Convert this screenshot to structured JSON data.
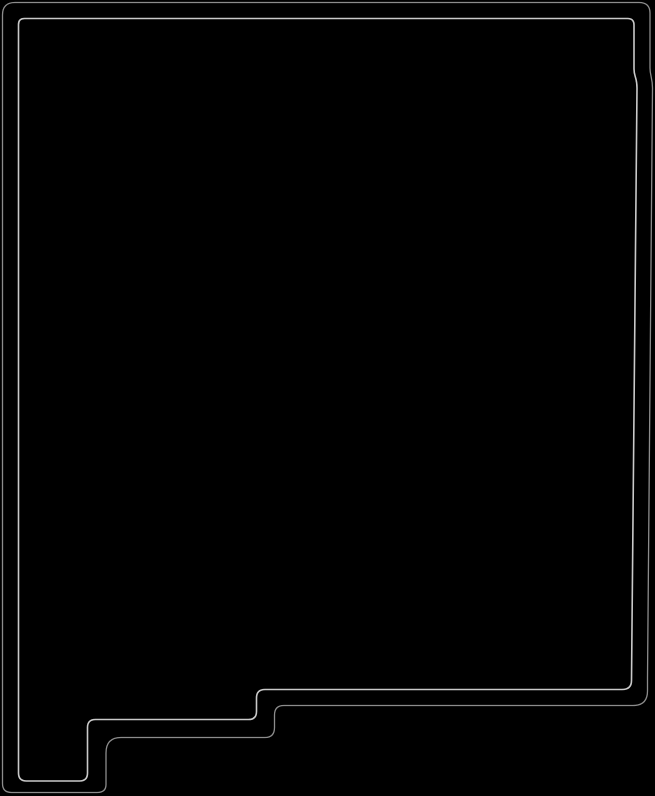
{
  "figure": {
    "icon_name": "new-mexico-state-outline-icon",
    "shape": "Silhouette of the U.S. state of New Mexico traced as a thin double outline on a black field",
    "background_color": "#000000",
    "outer_outline_color": "#8c8c8c",
    "inner_outline_color": "#c9c9c9",
    "paths": {
      "outer_border_d": "M 2.5,15 Q 2.5,2.5 15,2.5 L 639,2.5 Q 650,2.5 650,13 L 650,68 C 650,76 652.5,78 652.5,88 L 647.5,678 L 647.5,691 Q 647.5,705.5 633,705.5 L 284,705.5 Q 274.5,705.5 274.5,715 L 274.5,727.5 Q 274.5,737.5 265,737.5 L 121,737.5 Q 106,737.5 106,753 L 106,784.5 Q 106,792.5 97,792.5 L 11.5,792.5 Q 2.5,792.5 2.5,783.5 Z",
      "inner_border_d": "M 18.5,24.5 Q 18.5,18.5 24.5,18.5 L 627.5,18.5 Q 634,18.5 634,25 L 634,69 C 634,77 637,77 637,88 L 631.5,680.5 Q 631.5,689.5 622,689.5 L 265,689.5 Q 256.5,689.5 256.5,698 L 256.5,711.5 Q 256.5,719.5 248.5,719.5 L 95.5,719.5 Q 87.5,719.5 87.5,727.5 L 87.5,773 Q 87.5,781 79.5,781 L 26.5,781 Q 18.5,781 18.5,773 Z"
    }
  }
}
